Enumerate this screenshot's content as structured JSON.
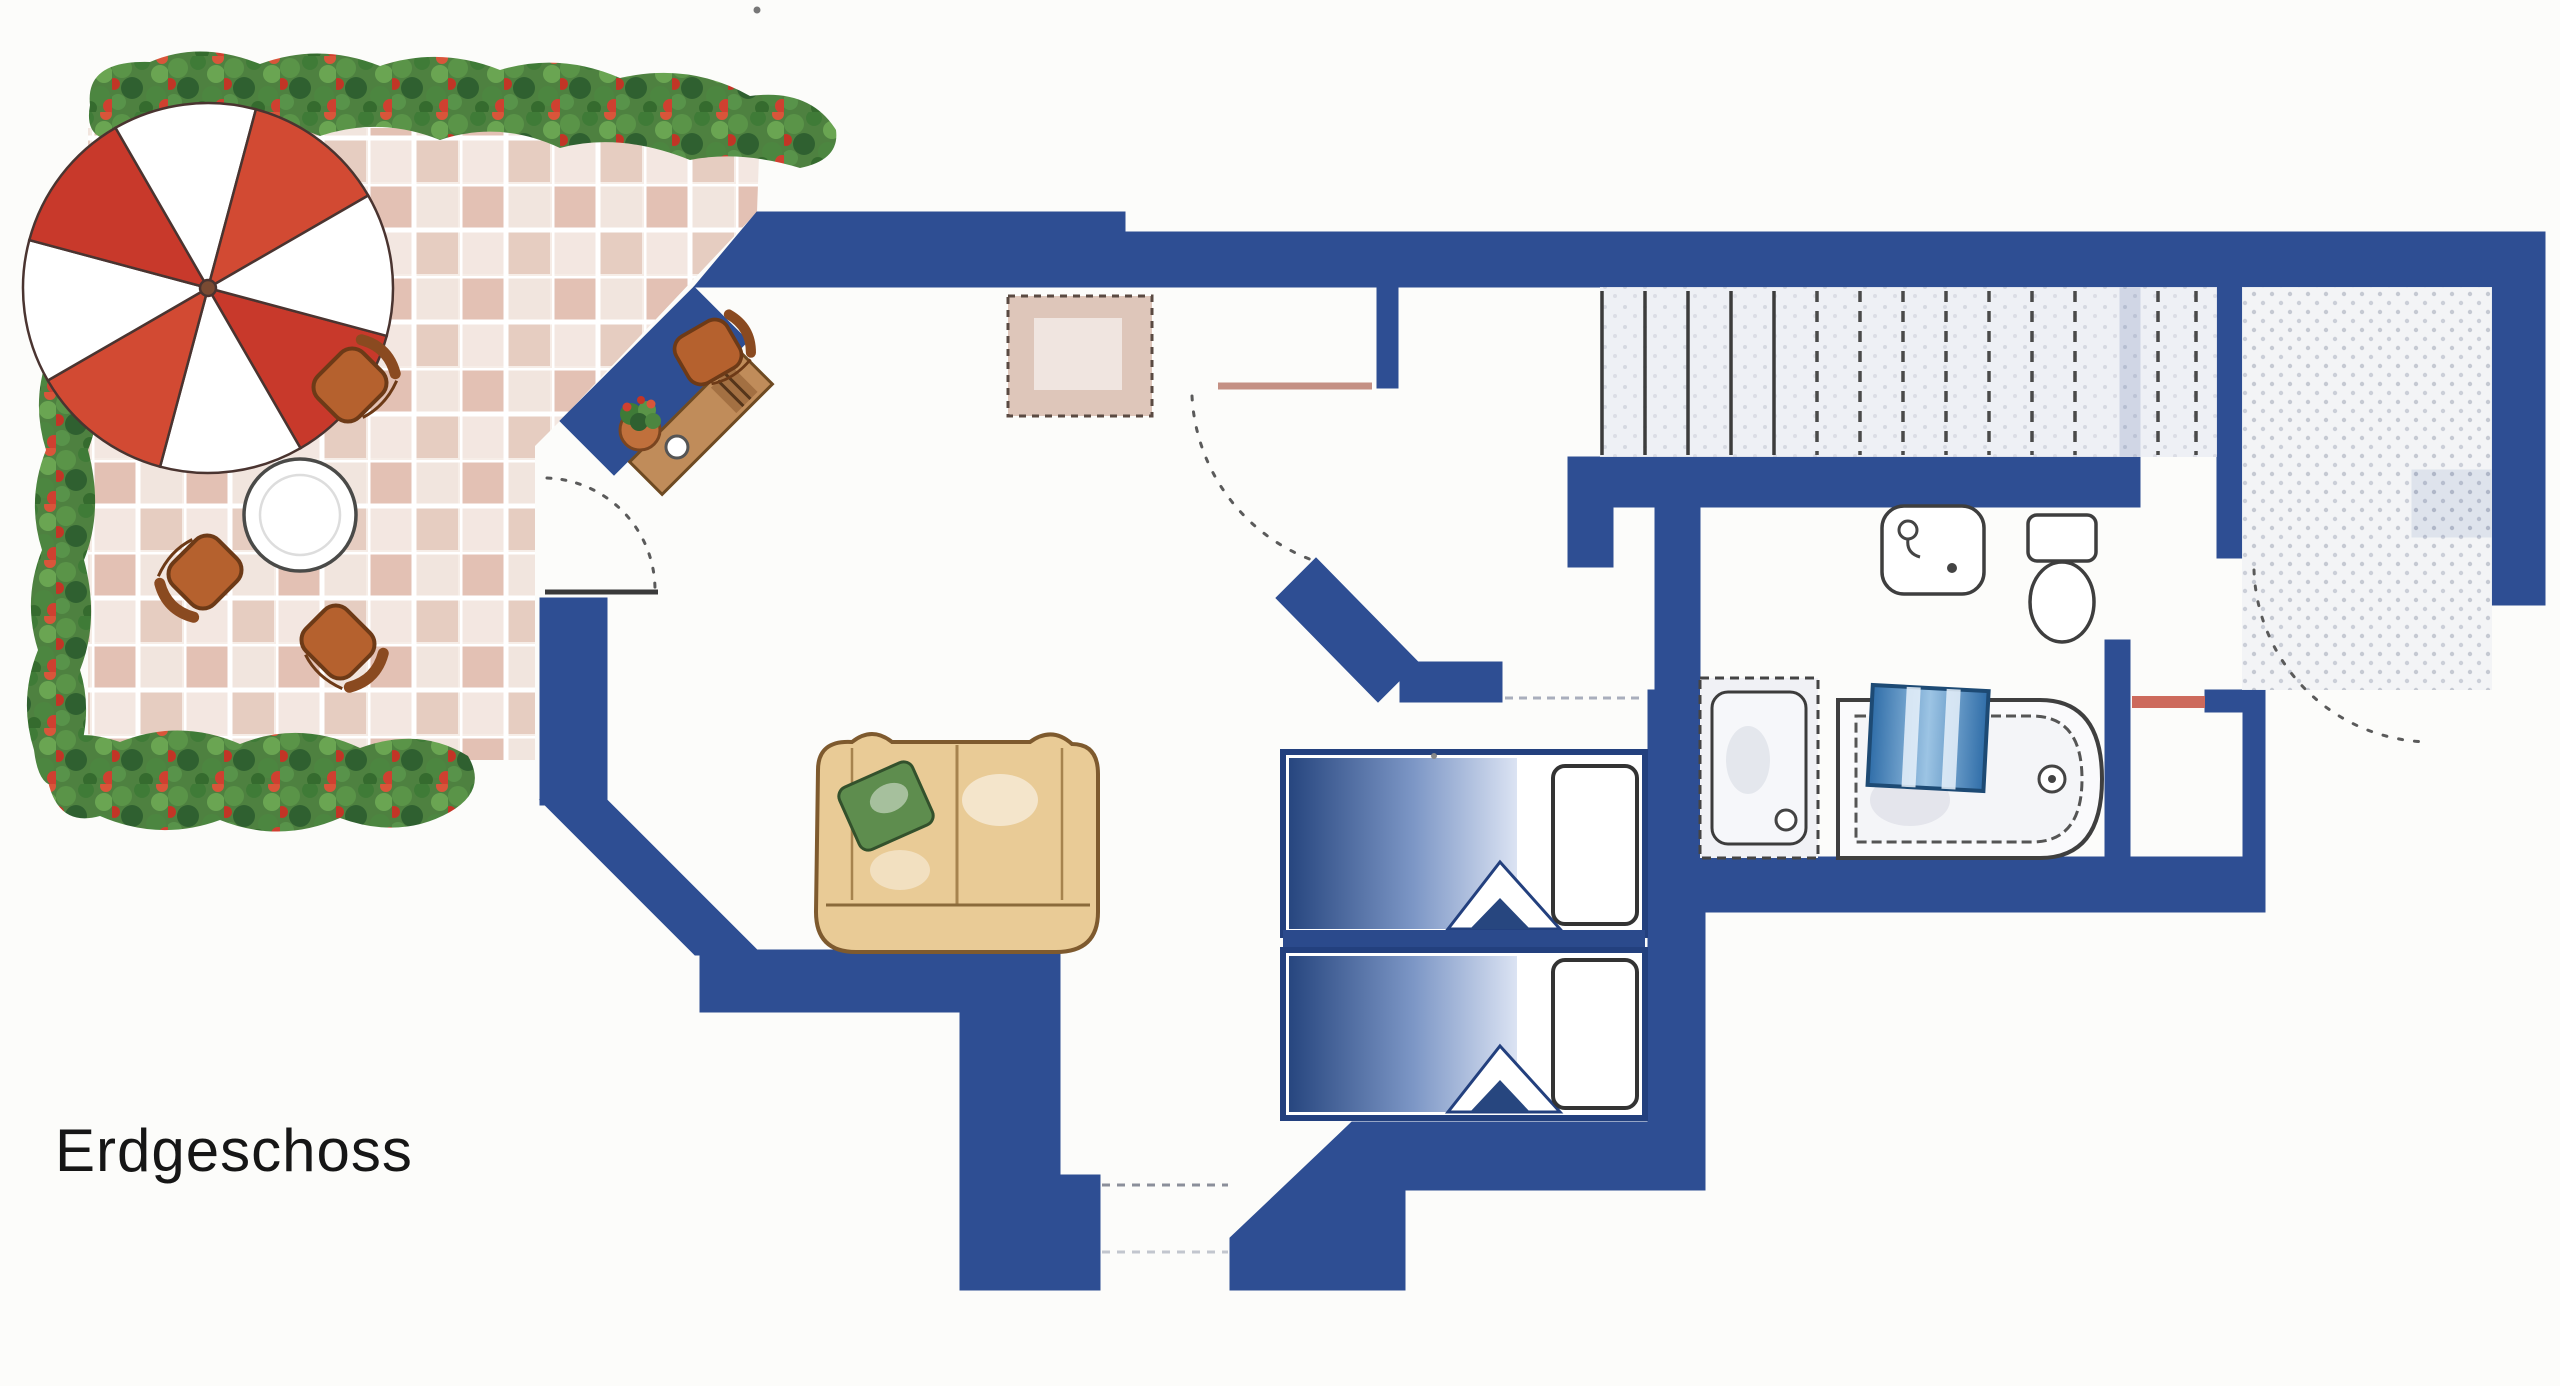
{
  "title": {
    "label": "Erdgeschoss"
  },
  "plan": {
    "kind": "apartment-floor-plan",
    "visible_label": "Erdgeschoss",
    "colors": {
      "wall": "#2e4e93",
      "terrace_tile": "#dcb5a5",
      "foliage_green": "#46783c",
      "flower_red": "#cf4030",
      "umbrella_red": "#c8392b",
      "furniture_wood": "#b5612e",
      "sofa_tan": "#e9cb96",
      "cushion_green": "#5e8d4e",
      "blanket_blue": "#2b4d90",
      "towel_blue": "#7fb4dd",
      "door_leaf_pink": "#c49084",
      "threshold_red": "#cd6a5c"
    },
    "depicted_elements": [
      "terrace",
      "flower-border",
      "parasol",
      "garden-table",
      "garden-chairs",
      "terrace-door",
      "desk",
      "desk-chair",
      "potted-plant",
      "dining-table",
      "sofa",
      "interior-door",
      "twin-beds",
      "staircase",
      "washbasin",
      "toilet",
      "shower",
      "bathtub",
      "entry-hall",
      "front-door"
    ]
  }
}
